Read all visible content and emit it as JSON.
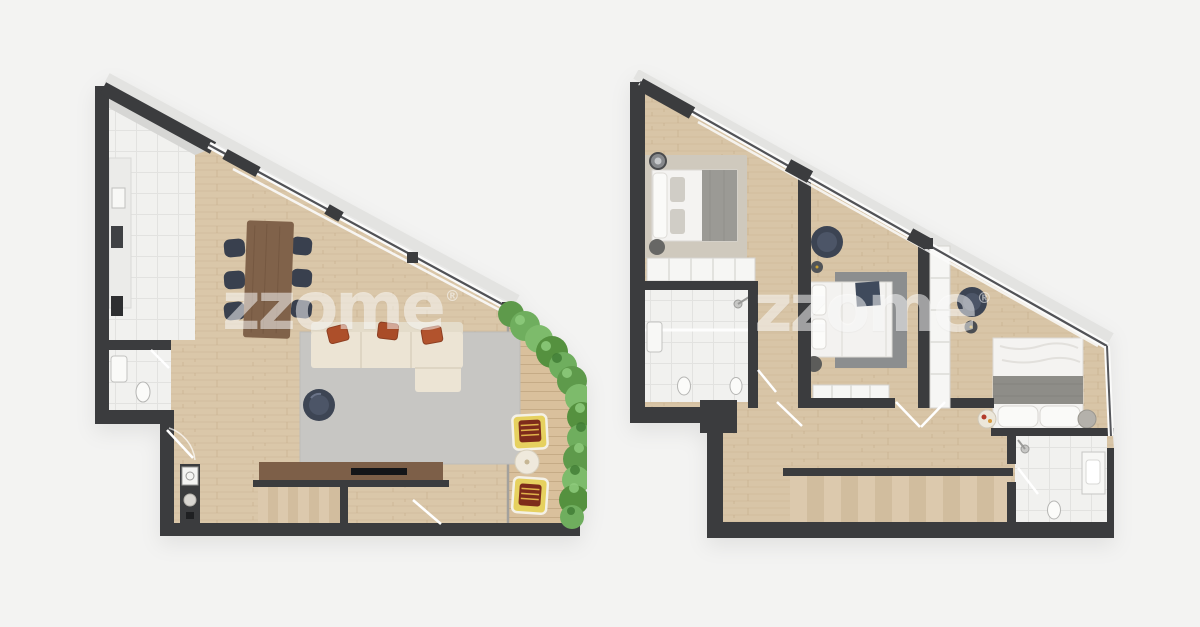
{
  "canvas": {
    "width": 1200,
    "height": 627,
    "background": "#f3f3f2"
  },
  "watermark": {
    "text": "zzome",
    "registered": "®",
    "color": "rgba(255,255,255,0.52)"
  },
  "palette": {
    "wall_dark": "#3b3c3e",
    "roof_band": "#e3e3e1",
    "wood_floor": "#dac7a9",
    "terrace_deck": "#d9c09c",
    "tile_white": "#f1f1ef",
    "rug_gray": "#c7c6c3",
    "rug_dark_gray": "#8c8e8f",
    "rug_beige": "#cfc9bd",
    "sofa_cream": "#ece4d4",
    "pillow_terracotta": "#ad4f2a",
    "walnut_wood": "#7d5f48",
    "chair_navy": "#3c4453",
    "lounge_yellow": "#e6d15f",
    "hedge_green": "#6fae5e",
    "bed_white": "#f4f3f1",
    "blanket_gray": "#8e8d88"
  },
  "plans": [
    {
      "id": "lower-floor",
      "label": "lower-floor-plan",
      "rooms": [
        "kitchen",
        "wc",
        "living-dining-room",
        "staircase",
        "terrace"
      ],
      "furniture": [
        "kitchen-counter",
        "sink",
        "cooktop",
        "wc-sink",
        "wc-toilet",
        "dining-table",
        "dining-chair-x6",
        "sectional-sofa",
        "throw-pillow-x3",
        "area-rug",
        "swivel-armchair",
        "tv-sideboard",
        "tv",
        "washing-machine",
        "stairs-down",
        "lounge-chair-x2",
        "terrace-side-table",
        "planter-hedge"
      ]
    },
    {
      "id": "upper-floor",
      "label": "upper-floor-plan",
      "rooms": [
        "bedroom-1",
        "bathroom",
        "hallway",
        "bedroom-2",
        "bedroom-3",
        "ensuite-bathroom",
        "staircase"
      ],
      "furniture": [
        "double-bed-x3",
        "bedroom-rug-x2",
        "wardrobe-x3",
        "armchair-x2",
        "pouf-x2",
        "vanity-mirror",
        "bathroom-sink",
        "toilet-x3",
        "shower-x2",
        "nightstand-x2",
        "side-table-x2",
        "stairs-down"
      ]
    }
  ]
}
